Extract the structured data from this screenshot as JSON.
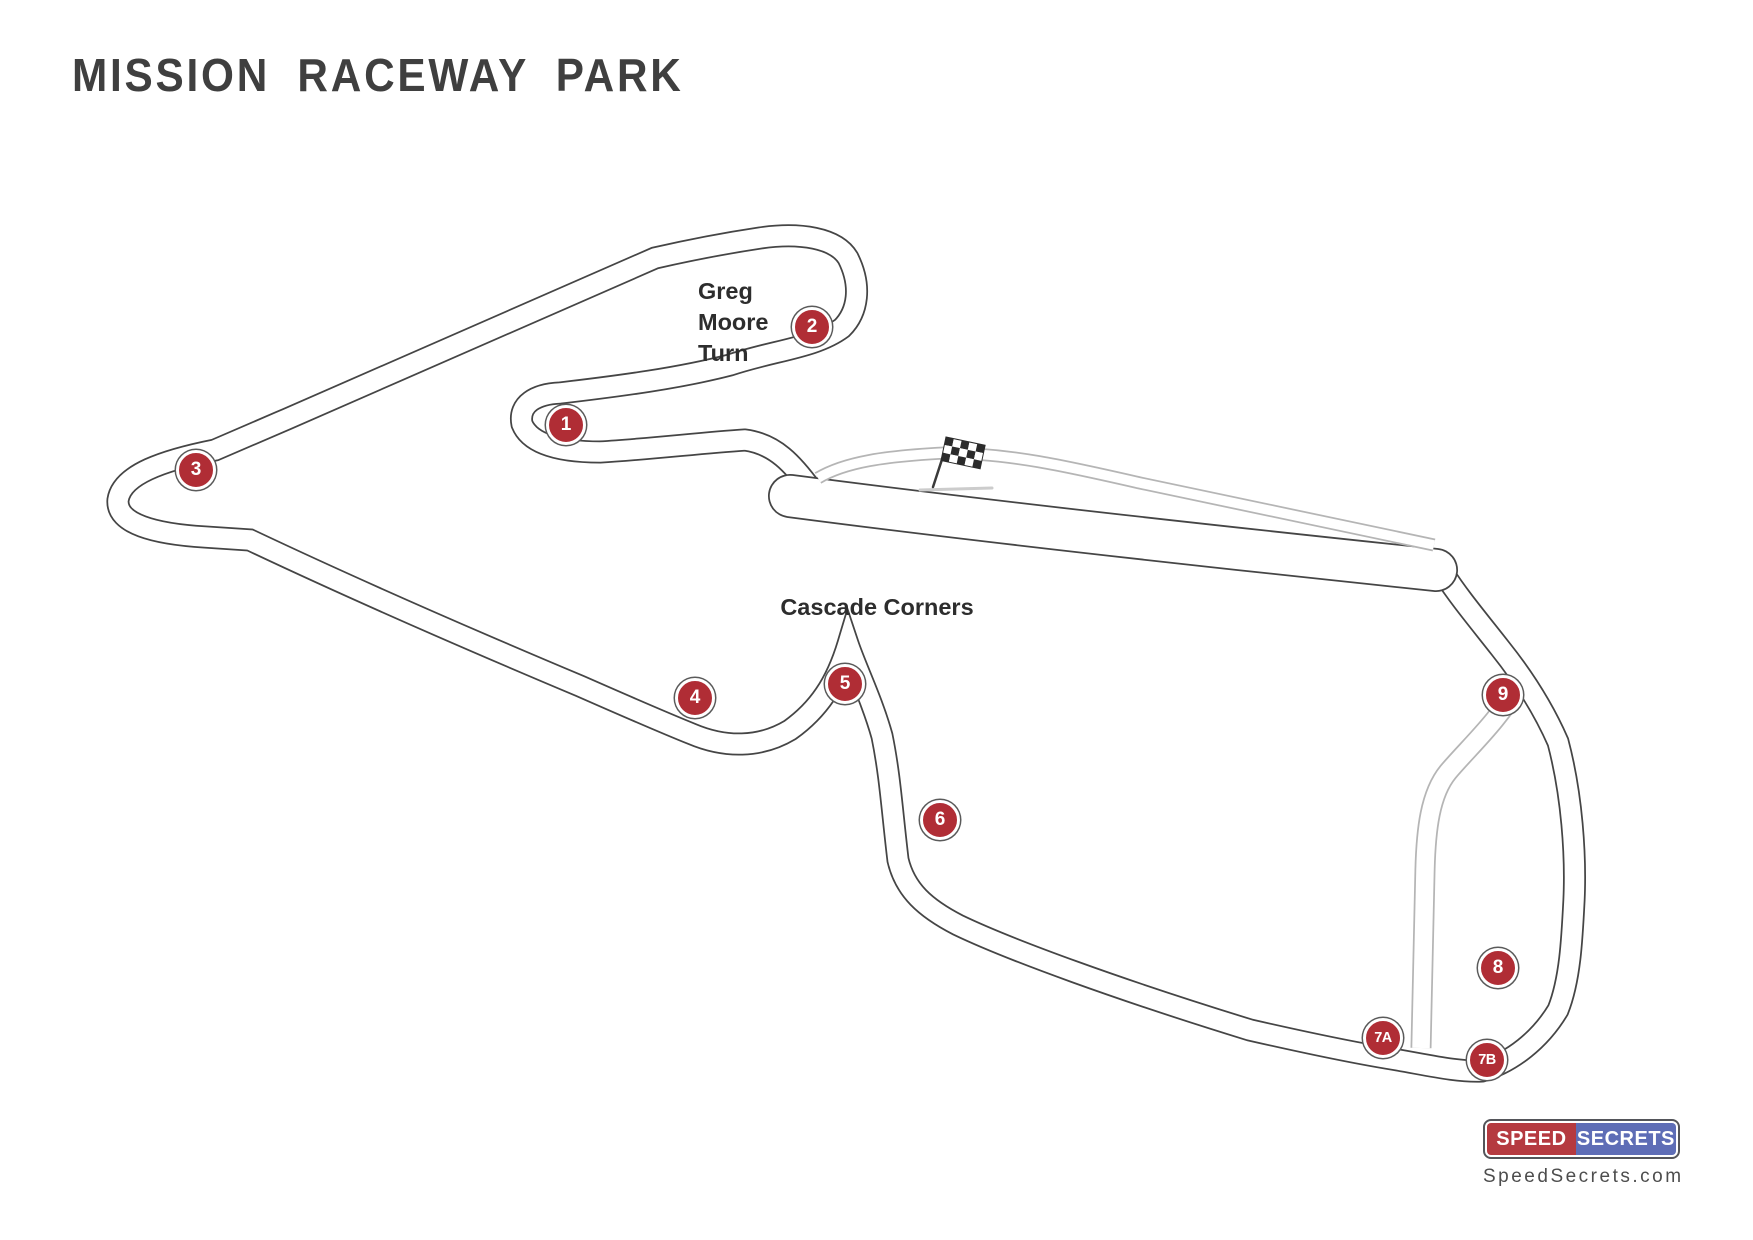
{
  "title": {
    "text": "MISSION RACEWAY PARK"
  },
  "labels": {
    "greg_moore": {
      "text": "Greg\nMoore\nTurn",
      "x": 698,
      "y": 276
    },
    "cascade": {
      "text": "Cascade Corners",
      "x": 877,
      "y": 592
    }
  },
  "track": {
    "name": "Mission Raceway Park road course",
    "markers": [
      {
        "id": "1",
        "label": "1",
        "x": 566,
        "y": 425
      },
      {
        "id": "2",
        "label": "2",
        "x": 812,
        "y": 327
      },
      {
        "id": "3",
        "label": "3",
        "x": 196,
        "y": 470
      },
      {
        "id": "4",
        "label": "4",
        "x": 695,
        "y": 698
      },
      {
        "id": "5",
        "label": "5",
        "x": 845,
        "y": 684
      },
      {
        "id": "6",
        "label": "6",
        "x": 940,
        "y": 820
      },
      {
        "id": "7A",
        "label": "7A",
        "x": 1383,
        "y": 1038
      },
      {
        "id": "7B",
        "label": "7B",
        "x": 1487,
        "y": 1060
      },
      {
        "id": "8",
        "label": "8",
        "x": 1498,
        "y": 968
      },
      {
        "id": "9",
        "label": "9",
        "x": 1503,
        "y": 695
      }
    ]
  },
  "colors": {
    "marker_red": "#b02d35",
    "track_line": "#454545",
    "gray_road": "#b5b5b5",
    "title": "#3f3f3f",
    "label": "#2d2d2d",
    "logo_red": "#b53a40",
    "logo_blue": "#5e6db6"
  },
  "logo": {
    "speed": "SPEED",
    "secrets": "SECRETS",
    "site": "SpeedSecrets.com"
  }
}
